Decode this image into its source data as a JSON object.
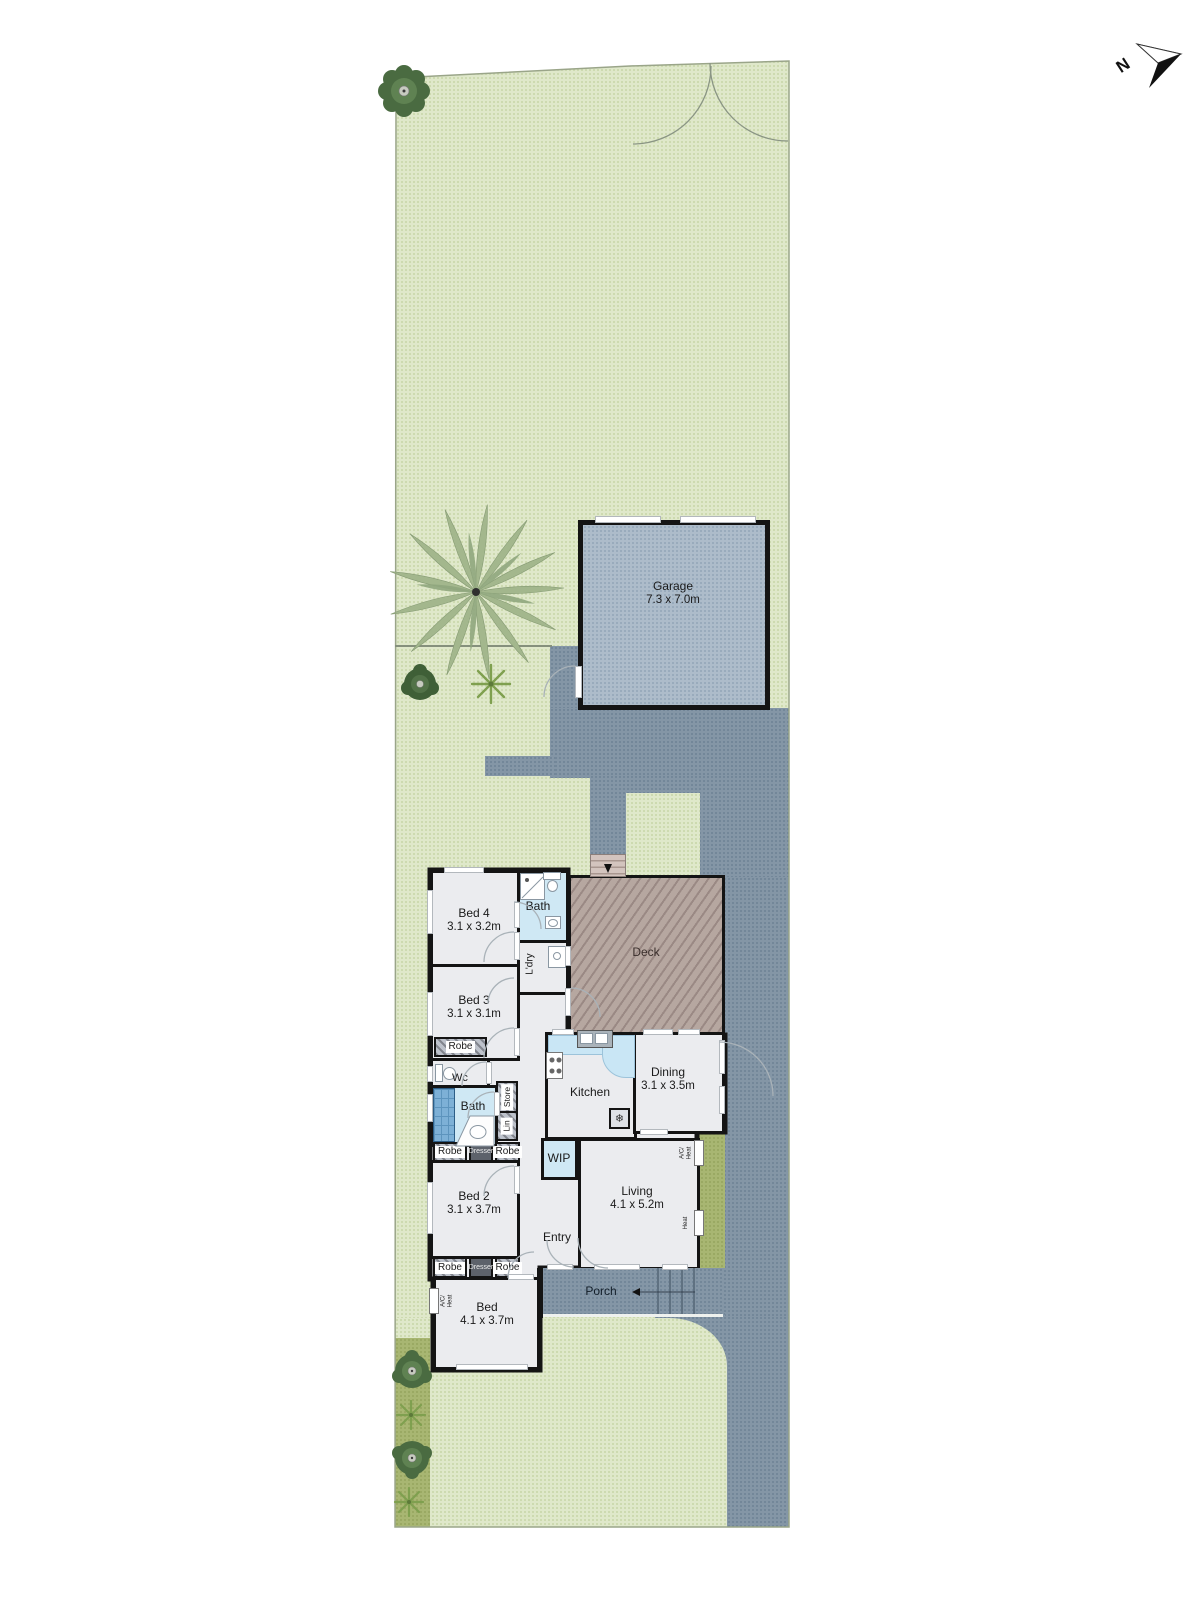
{
  "compass": {
    "label": "N"
  },
  "rooms": {
    "garage": {
      "label": "Garage",
      "dims": "7.3 x 7.0m"
    },
    "bed4": {
      "label": "Bed 4",
      "dims": "3.1 x 3.2m"
    },
    "bed3": {
      "label": "Bed 3",
      "dims": "3.1 x 3.1m"
    },
    "bed2": {
      "label": "Bed 2",
      "dims": "3.1 x 3.7m"
    },
    "bed1": {
      "label": "Bed",
      "dims": "4.1 x 3.7m"
    },
    "bath_upper": {
      "label": "Bath"
    },
    "bath_main": {
      "label": "Bath"
    },
    "laundry": {
      "label": "L'dry"
    },
    "deck": {
      "label": "Deck"
    },
    "wc": {
      "label": "Wc"
    },
    "kitchen": {
      "label": "Kitchen"
    },
    "dining": {
      "label": "Dining",
      "dims": "3.1 x 3.5m"
    },
    "wip": {
      "label": "WIP"
    },
    "living": {
      "label": "Living",
      "dims": "4.1 x 5.2m"
    },
    "entry": {
      "label": "Entry"
    },
    "porch": {
      "label": "Porch"
    }
  },
  "fixtures": {
    "robe": "Robe",
    "dresser": "Dresser",
    "store": "Store",
    "linen": "Lin",
    "ac_heat": "A/C/\nHeat",
    "heat": "Heat",
    "snowflake_icon": "❄"
  },
  "palette": {
    "lawn": "#dfe8ca",
    "garden_bed": "#a8b672",
    "paving": "#8496a6",
    "garage_floor": "#adbcca",
    "deck": "#b6a7a0",
    "room": "#ebecef",
    "wet_area": "#cfe8f4",
    "wall": "#141414"
  }
}
